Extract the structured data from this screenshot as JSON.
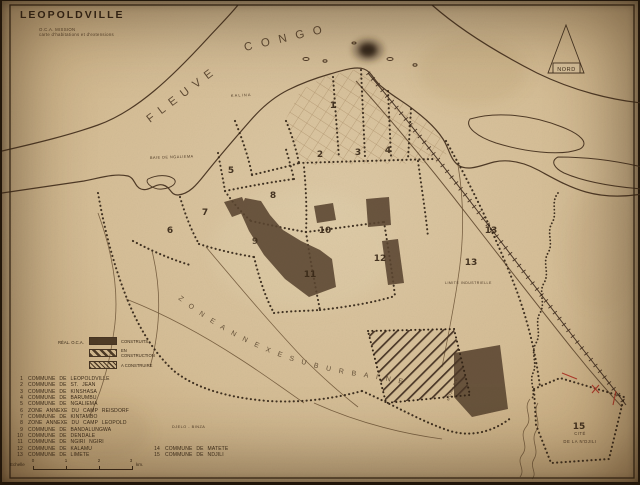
{
  "title": "LEOPOLDVILLE",
  "subtitle": {
    "line1": "O.C.A. MISSION",
    "line2": "carte d'habitations et d'extensions"
  },
  "compass": {
    "label": "NORD"
  },
  "river_labels": {
    "fleuve": "FLEUVE",
    "congo": "CONGO"
  },
  "map_labels": {
    "kalina": "KALINA",
    "baie": "BAIE DE NGALIEMA",
    "suburb": "Z O N E   A N N E X E   S U B U R B A I N E",
    "djelo": "DJELO - BINZA",
    "limite_ind": "LIMITE INDUSTRIELLE",
    "cite1": "CITÉ",
    "cite2": "DE LA N'DJILI",
    "ndjili_riv": "N'DJILI RIV."
  },
  "zones": {
    "z1": "1",
    "z2": "2",
    "z3": "3",
    "z4": "4",
    "z5": "5",
    "z6": "6",
    "z7": "7",
    "z8": "8",
    "z9": "9",
    "z10": "10",
    "z11": "11",
    "z12": "12",
    "z13": "13",
    "z15": "15"
  },
  "construction_legend": {
    "header": "RÉAL. O.C.A.",
    "items": [
      {
        "label": "CONSTRUITS"
      },
      {
        "label": "EN CONSTRUCTION"
      },
      {
        "label": "A CONSTRUIRE"
      }
    ]
  },
  "communes_legend": {
    "items": [
      {
        "num": "1",
        "label": "COMMUNE DE LEOPOLDVILLE"
      },
      {
        "num": "2",
        "label": "COMMUNE DE ST. JEAN"
      },
      {
        "num": "3",
        "label": "COMMUNE DE KINSHASA"
      },
      {
        "num": "4",
        "label": "COMMUNE DE BARUMBU"
      },
      {
        "num": "5",
        "label": "COMMUNE DE NGALIEMA"
      },
      {
        "num": "6",
        "label": "ZONE ANNEXE DU CAMP REISDORF"
      },
      {
        "num": "7",
        "label": "COMMUNE DE KINTAMBO"
      },
      {
        "num": "8",
        "label": "ZONE ANNEXE DU CAMP LEOPOLD"
      },
      {
        "num": "9",
        "label": "COMMUNE DE BANDALUNGWA"
      },
      {
        "num": "10",
        "label": "COMMUNE DE DENDALE"
      },
      {
        "num": "11",
        "label": "COMMUNE DE NGIRI NGIRI"
      },
      {
        "num": "12",
        "label": "COMMUNE DE KALAMU"
      },
      {
        "num": "13",
        "label": "COMMUNE DE LIMETE"
      },
      {
        "num": "14",
        "label": "COMMUNE DE MATETE"
      },
      {
        "num": "15",
        "label": "COMMUNE DE NDJILI"
      }
    ]
  },
  "scale": {
    "label": "Echelle",
    "t0": "0",
    "t1": "1",
    "t2": "2",
    "t3": "3",
    "unit": "km."
  },
  "colors": {
    "paper": "#d6be96",
    "ink": "#3b2a18",
    "built_fill": "#5a4530",
    "annotation_red": "#b03a2a"
  }
}
